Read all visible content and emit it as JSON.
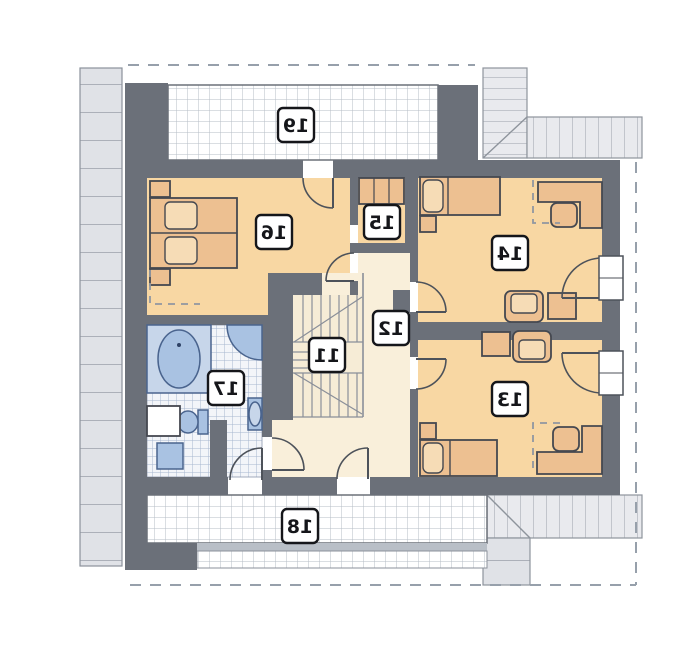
{
  "plan": {
    "type": "attic-floor-plan",
    "labels_mirrored": true,
    "rooms": {
      "stairs": {
        "label": "11"
      },
      "hall": {
        "label": "12"
      },
      "bedroom_right_lower": {
        "label": "13"
      },
      "bedroom_right_upper": {
        "label": "14"
      },
      "wardrobe": {
        "label": "15"
      },
      "bedroom_left": {
        "label": "16"
      },
      "bathroom": {
        "label": "17"
      },
      "terrace_lower": {
        "label": "18"
      },
      "terrace_upper": {
        "label": "19"
      }
    },
    "colors": {
      "wall": "#6b7079",
      "room_floor": "#f8d7a3",
      "hall_floor": "#f9efda",
      "furniture": "#edc091",
      "fixture_blue": "#a9c2e2",
      "roof_edge": "#e9eaee",
      "terrace_tile_line": "#b6bcc5",
      "bath_tile_line": "#a7b6d0"
    }
  }
}
